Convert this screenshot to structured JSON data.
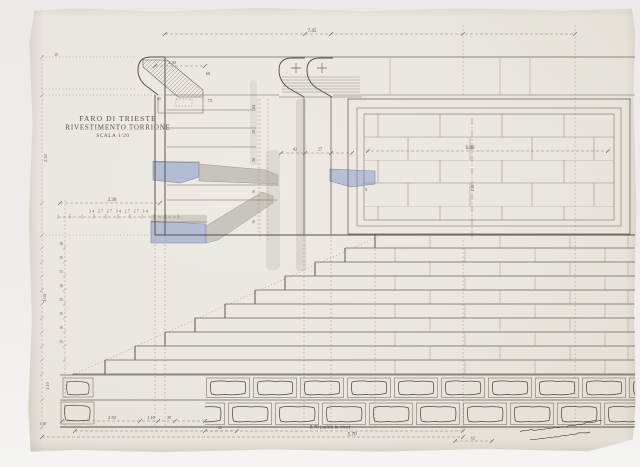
{
  "title": {
    "line1": "FARO DI TRIESTE",
    "line2": "RIVESTIMENTO TORRIONE",
    "line3": "SCALA 1/20"
  },
  "dims": {
    "overall_top": "7.45",
    "panel_width": "6.80",
    "ledge": "2.30",
    "coping_a": "42",
    "coping_b": "27",
    "cornice": "1.30",
    "zoccolo": "60",
    "block_h": "75",
    "block_w": "60",
    "tick_15": "15",
    "left_height_upper": "2.50",
    "left_height_steps": "3.04",
    "left_height_base": "1.10",
    "left_base_note": "1.50",
    "panel_center_height": "2.30",
    "module_row": "34 27 27 34 27 27 34",
    "base_250": "2.50",
    "base_110": "1.10",
    "base_28": "28",
    "base_62_left": "62",
    "base_62_right": "62",
    "mark_3": "3",
    "step_ticks": [
      "16",
      "15",
      "15",
      "16",
      "15",
      "15",
      "16",
      "15"
    ],
    "course_ticks": [
      "84",
      "20",
      "28",
      "16",
      "16"
    ]
  },
  "notes": {
    "plinth_line1": "8.70 (salita in vivo)",
    "plinth_line2": "5.70"
  }
}
